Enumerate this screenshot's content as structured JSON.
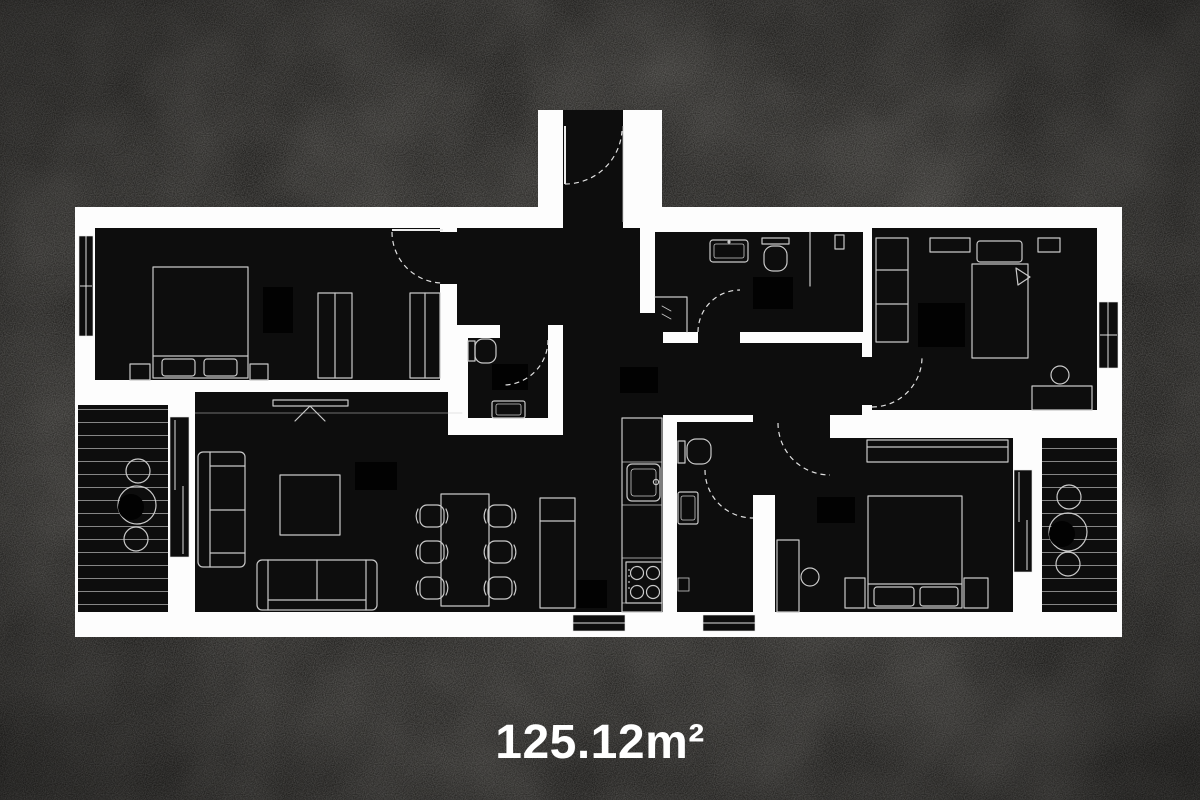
{
  "page": {
    "background_color": "#21201e"
  },
  "floor_plan": {
    "area_label": "125.12m²",
    "wall_color": "#fdfdfd",
    "room_color": "#0d0d0d",
    "accent_color": "#020202",
    "furniture_line_color": "#c9c9c9",
    "door_swing_color": "#e0e0e0",
    "deck_stripe_color": "#aeaeae",
    "label_color": "#ffffff"
  }
}
